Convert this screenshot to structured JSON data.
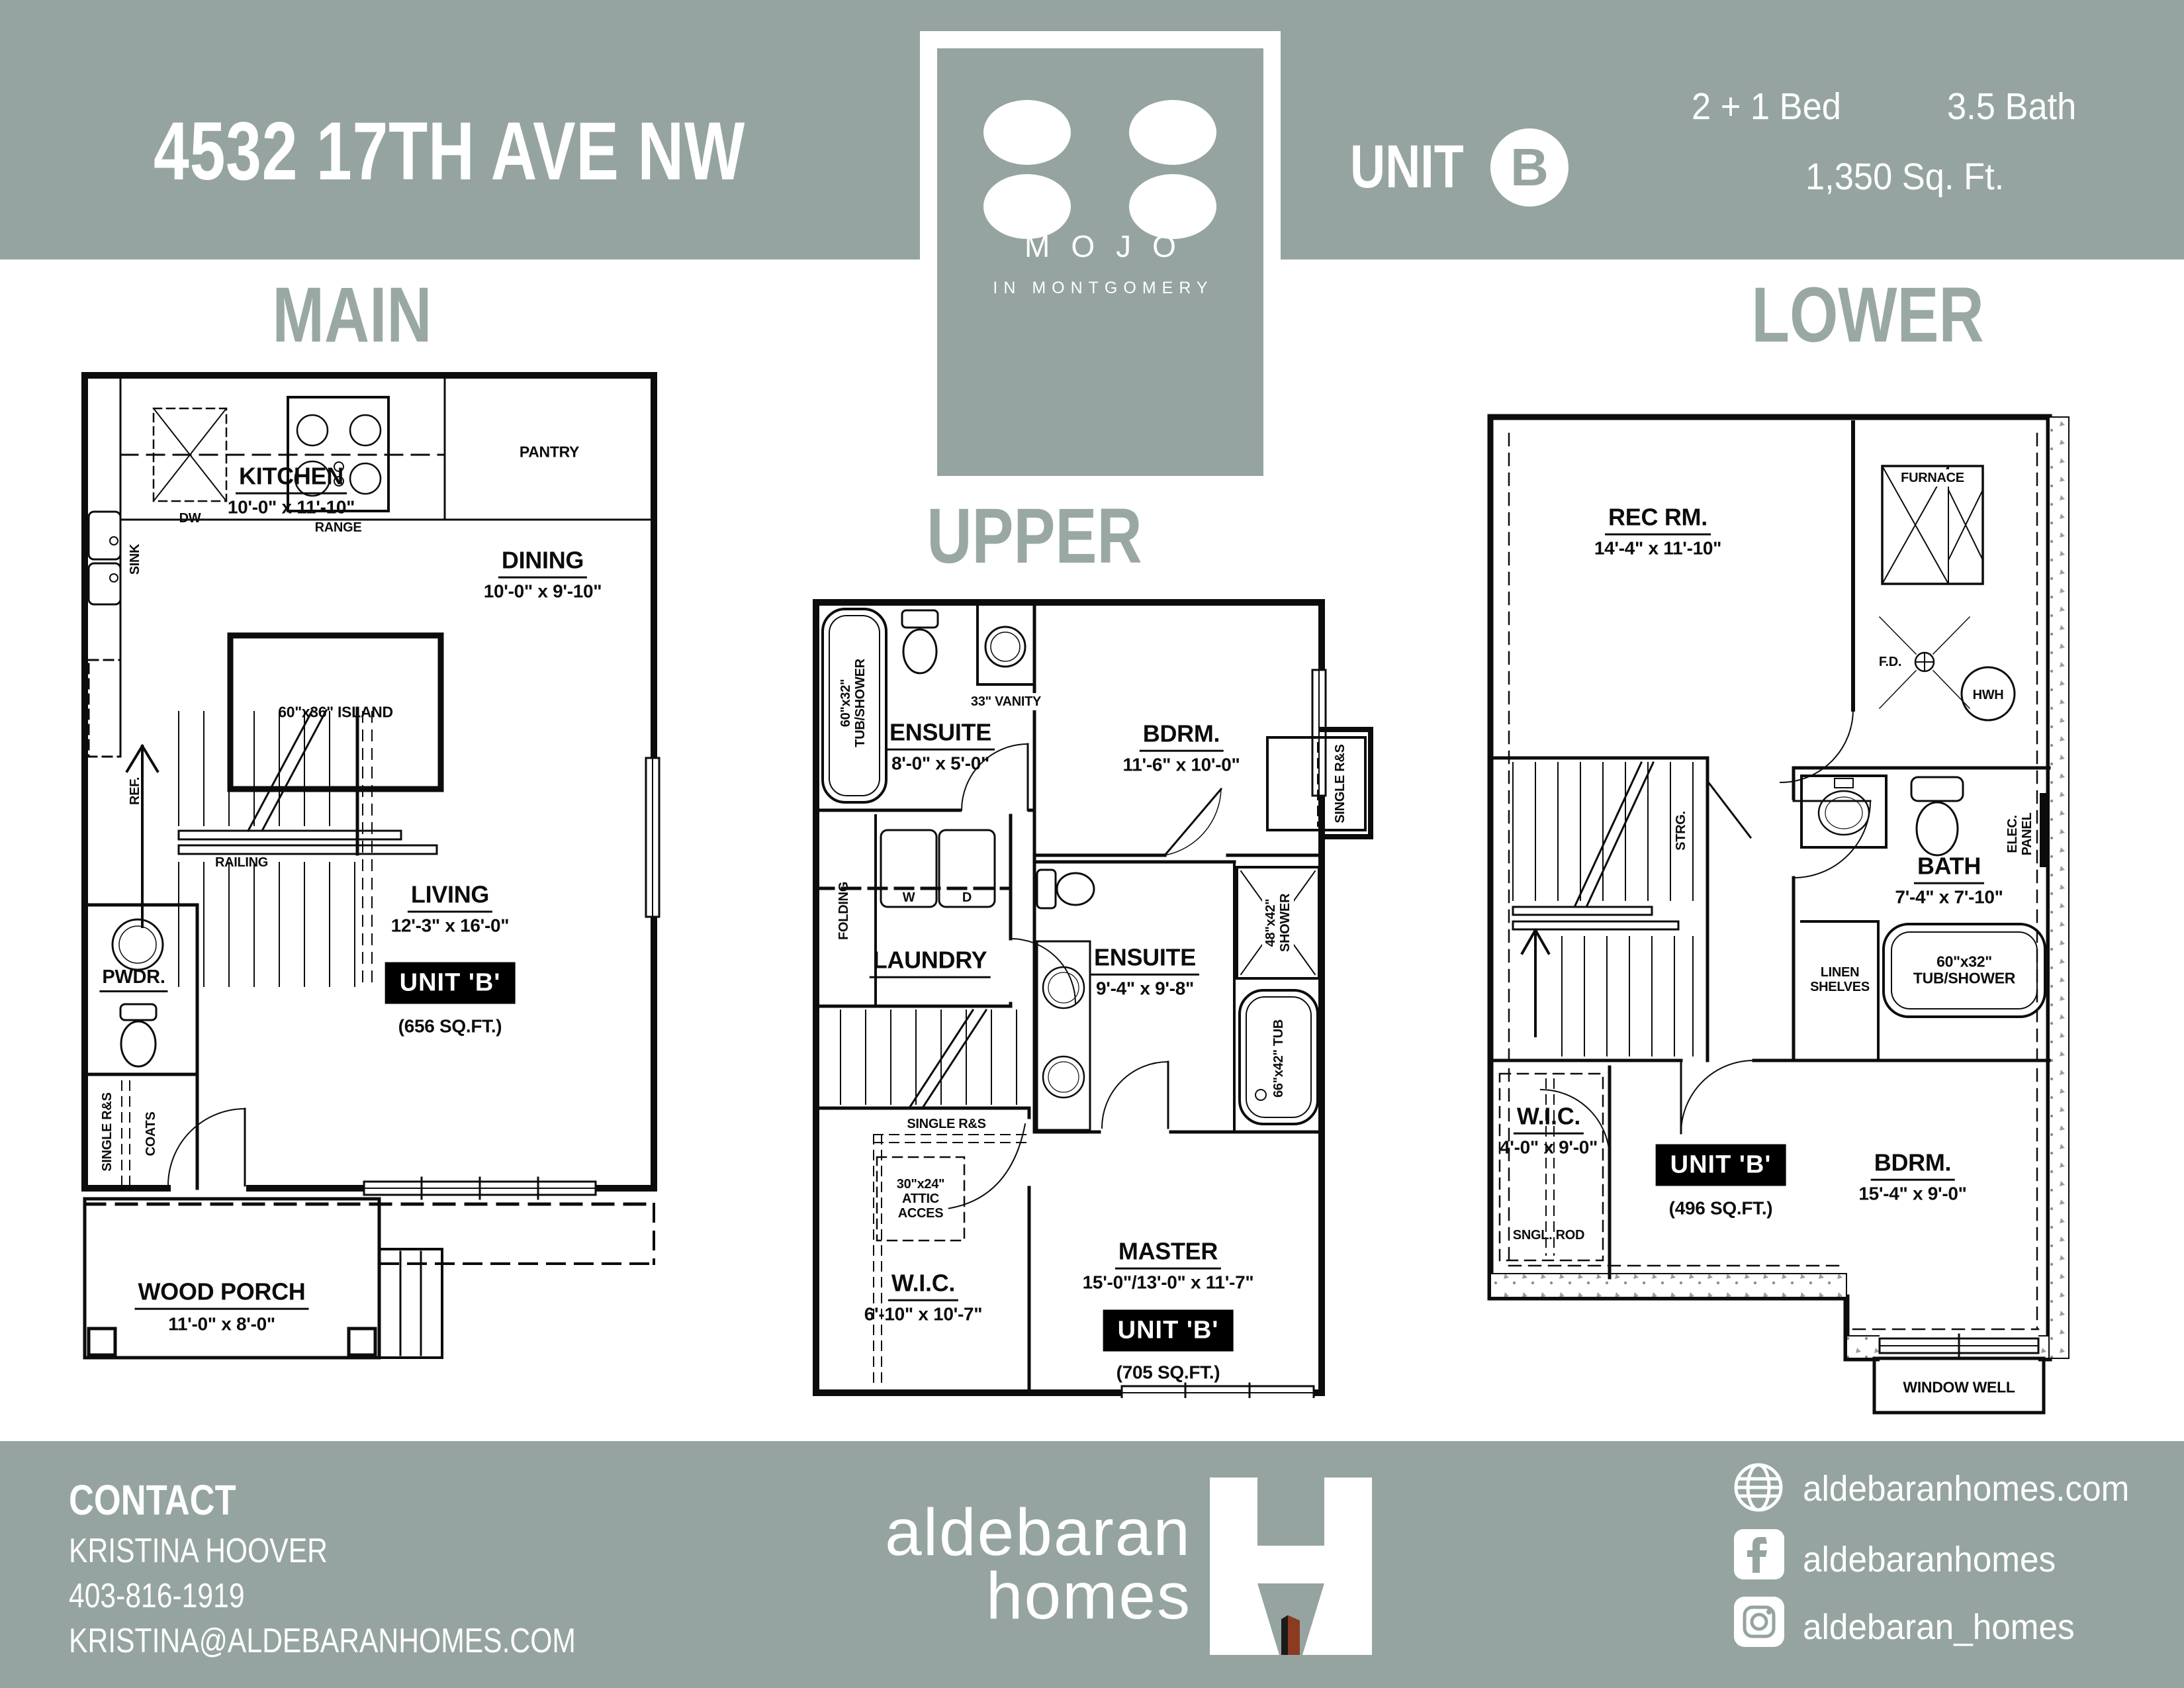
{
  "colors": {
    "band": "#95a4a0",
    "title": "#99a8a3",
    "ink": "#0c0c0c",
    "door_red": "#8c3a22"
  },
  "header": {
    "address": "4532 17TH AVE NW",
    "unit_label": "UNIT",
    "unit_letter": "B",
    "bed": "2 + 1 Bed",
    "bath": "3.5 Bath",
    "sqft": "1,350 Sq. Ft."
  },
  "logo": {
    "name": "MOJO",
    "tagline": "IN MONTGOMERY"
  },
  "floors": {
    "main": {
      "title": "MAIN",
      "labels": {
        "dw": "DW",
        "range": "RANGE",
        "pantry": "PANTRY",
        "sink": "SINK",
        "ref": "REF.",
        "kitchen": "KITCHEN",
        "kitchen_dims": "10'-0\" x 11'-10\"",
        "island": "60\"x36\" ISLAND",
        "dining": "DINING",
        "dining_dims": "10'-0\" x 9'-10\"",
        "railing": "RAILING",
        "living": "LIVING",
        "living_dims": "12'-3\" x 16'-0\"",
        "unit": "UNIT 'B'",
        "unit_sqft": "(656 SQ.FT.)",
        "pwdr": "PWDR.",
        "single_rs": "SINGLE R&S",
        "coats": "COATS",
        "porch": "WOOD PORCH",
        "porch_dims": "11'-0\" x 8'-0\""
      }
    },
    "upper": {
      "title": "UPPER",
      "labels": {
        "tub_l1": "60\"x32\"",
        "tub_l2": "TUB/SHOWER",
        "vanity": "33\" VANITY",
        "ensuite1": "ENSUITE",
        "ensuite1_dims": "8'-0\" x 5'-0\"",
        "bdrm": "BDRM.",
        "bdrm_dims": "11'-6\" x 10'-0\"",
        "folding": "FOLDING",
        "w": "W",
        "d": "D",
        "laundry": "LAUNDRY",
        "closet_rs": "SINGLE R&S",
        "ensuite2": "ENSUITE",
        "ensuite2_dims": "9'-4\" x 9'-8\"",
        "shower_l1": "48\"x42\"",
        "shower_l2": "SHOWER",
        "tub2": "66\"x42\" TUB",
        "wic_rs": "SINGLE R&S",
        "attic_l1": "30\"x24\"",
        "attic_l2": "ATTIC",
        "attic_l3": "ACCES",
        "wic": "W.I.C.",
        "wic_dims": "6'-10\" x 10'-7\"",
        "master": "MASTER",
        "master_dims": "15'-0\"/13'-0\" x 11'-7\"",
        "unit": "UNIT 'B'",
        "unit_sqft": "(705 SQ.FT.)"
      }
    },
    "lower": {
      "title": "LOWER",
      "labels": {
        "rec": "REC RM.",
        "rec_dims": "14'-4\" x 11'-10\"",
        "furnace": "FURNACE",
        "fd": "F.D.",
        "hwh": "HWH",
        "elec_l1": "ELEC.",
        "elec_l2": "PANEL",
        "strg": "STRG.",
        "bath": "BATH",
        "bath_dims": "7'-4\" x 7'-10\"",
        "linen_l1": "LINEN",
        "linen_l2": "SHELVES",
        "tub_l1": "60\"x32\"",
        "tub_l2": "TUB/SHOWER",
        "wic": "W.I.C.",
        "wic_dims": "4'-0\" x 9'-0\"",
        "sngl_rod": "SNGL. ROD",
        "unit": "UNIT 'B'",
        "unit_sqft": "(496 SQ.FT.)",
        "bdrm": "BDRM.",
        "bdrm_dims": "15'-4\" x 9'-0\"",
        "window_well": "WINDOW WELL"
      }
    }
  },
  "footer": {
    "contact": "CONTACT",
    "name": "KRISTINA HOOVER",
    "phone": "403-816-1919",
    "email": "KRISTINA@ALDEBARANHOMES.COM",
    "brand_top": "aldebaran",
    "brand_bottom": "homes",
    "website": "aldebaranhomes.com",
    "facebook": "aldebaranhomes",
    "instagram": "aldebaran_homes"
  }
}
